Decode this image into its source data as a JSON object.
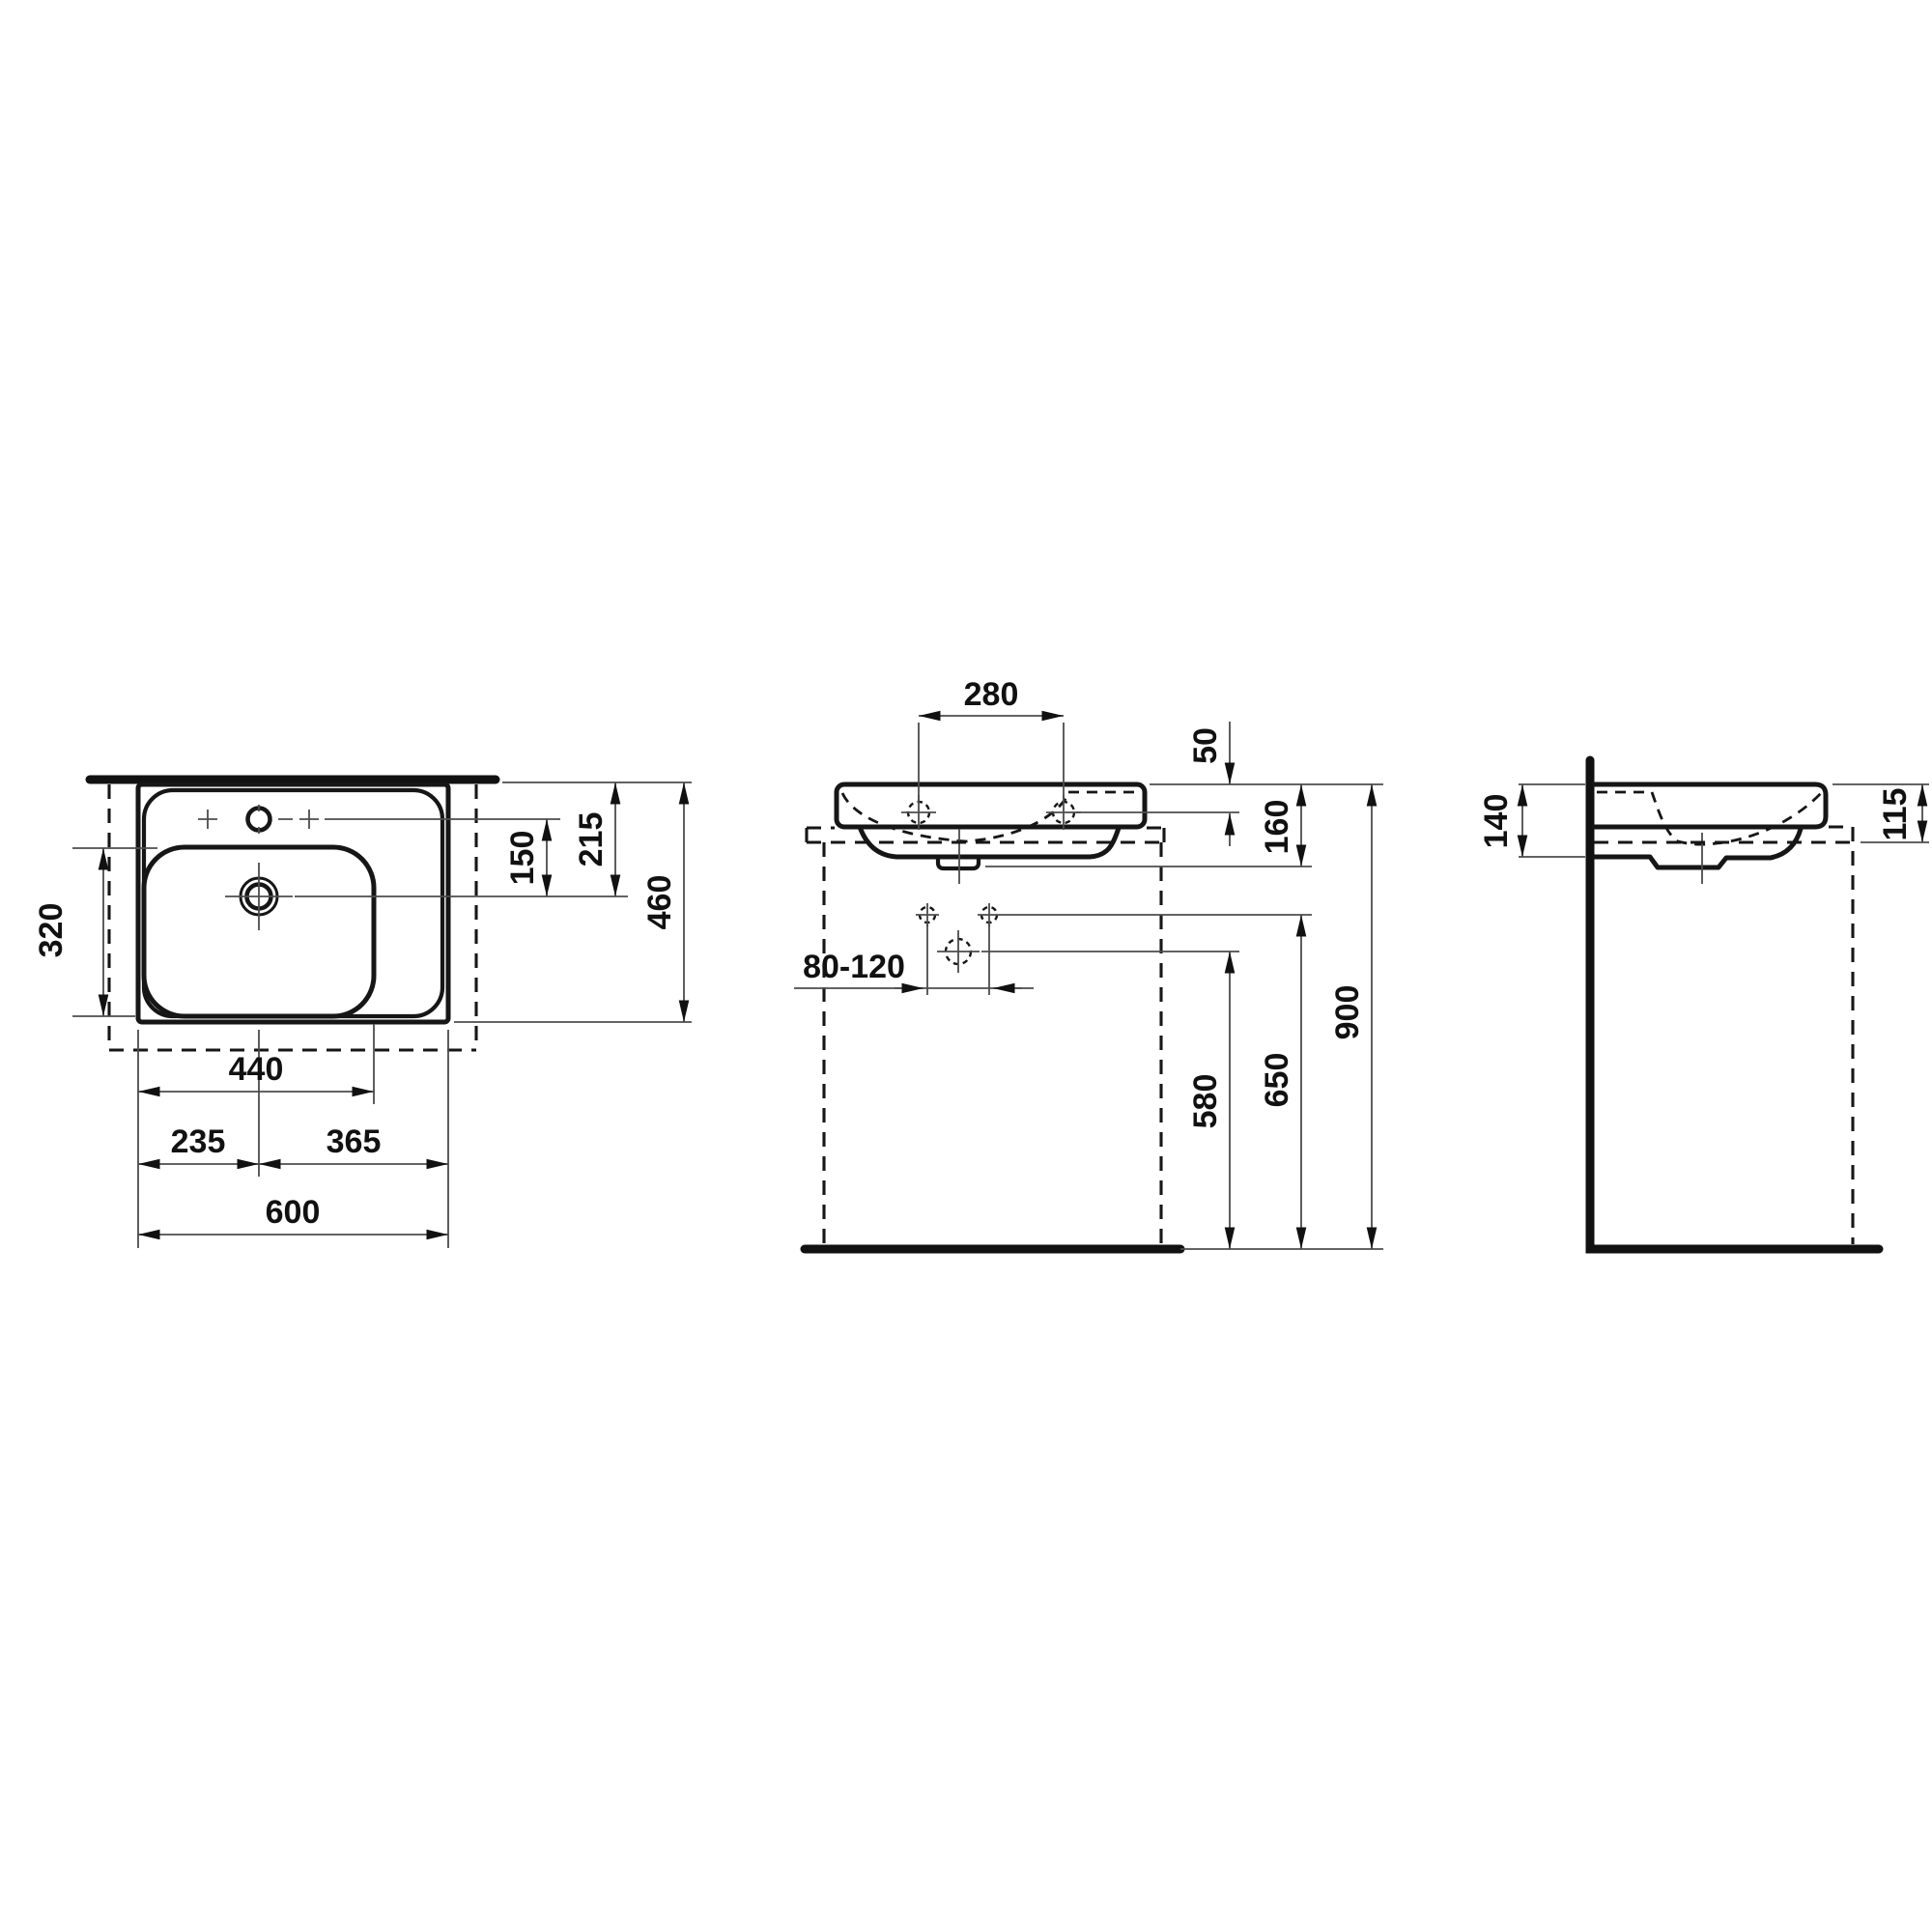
{
  "drawing": {
    "colors": {
      "line": "#161616",
      "thin_line": "#4d4d4d",
      "background": "#ffffff"
    },
    "plan": {
      "bowl_depth": "320",
      "tap_to_drain": "150",
      "top_edge_to_drain": "215",
      "overall_depth": "460",
      "edge_to_bowl_right": "440",
      "edge_to_drain": "235",
      "drain_to_edge": "365",
      "overall_width": "600"
    },
    "front": {
      "tap_hole_spacing": "280",
      "rim_to_tap_deck": "50",
      "rim_to_underside": "160",
      "fixing_hole_spacing": "80-120",
      "drain_outlet_height": "580",
      "fixing_hole_height": "650",
      "rim_height": "900"
    },
    "side": {
      "basin_height_at_wall": "140",
      "rim_above_worktop": "115"
    }
  }
}
